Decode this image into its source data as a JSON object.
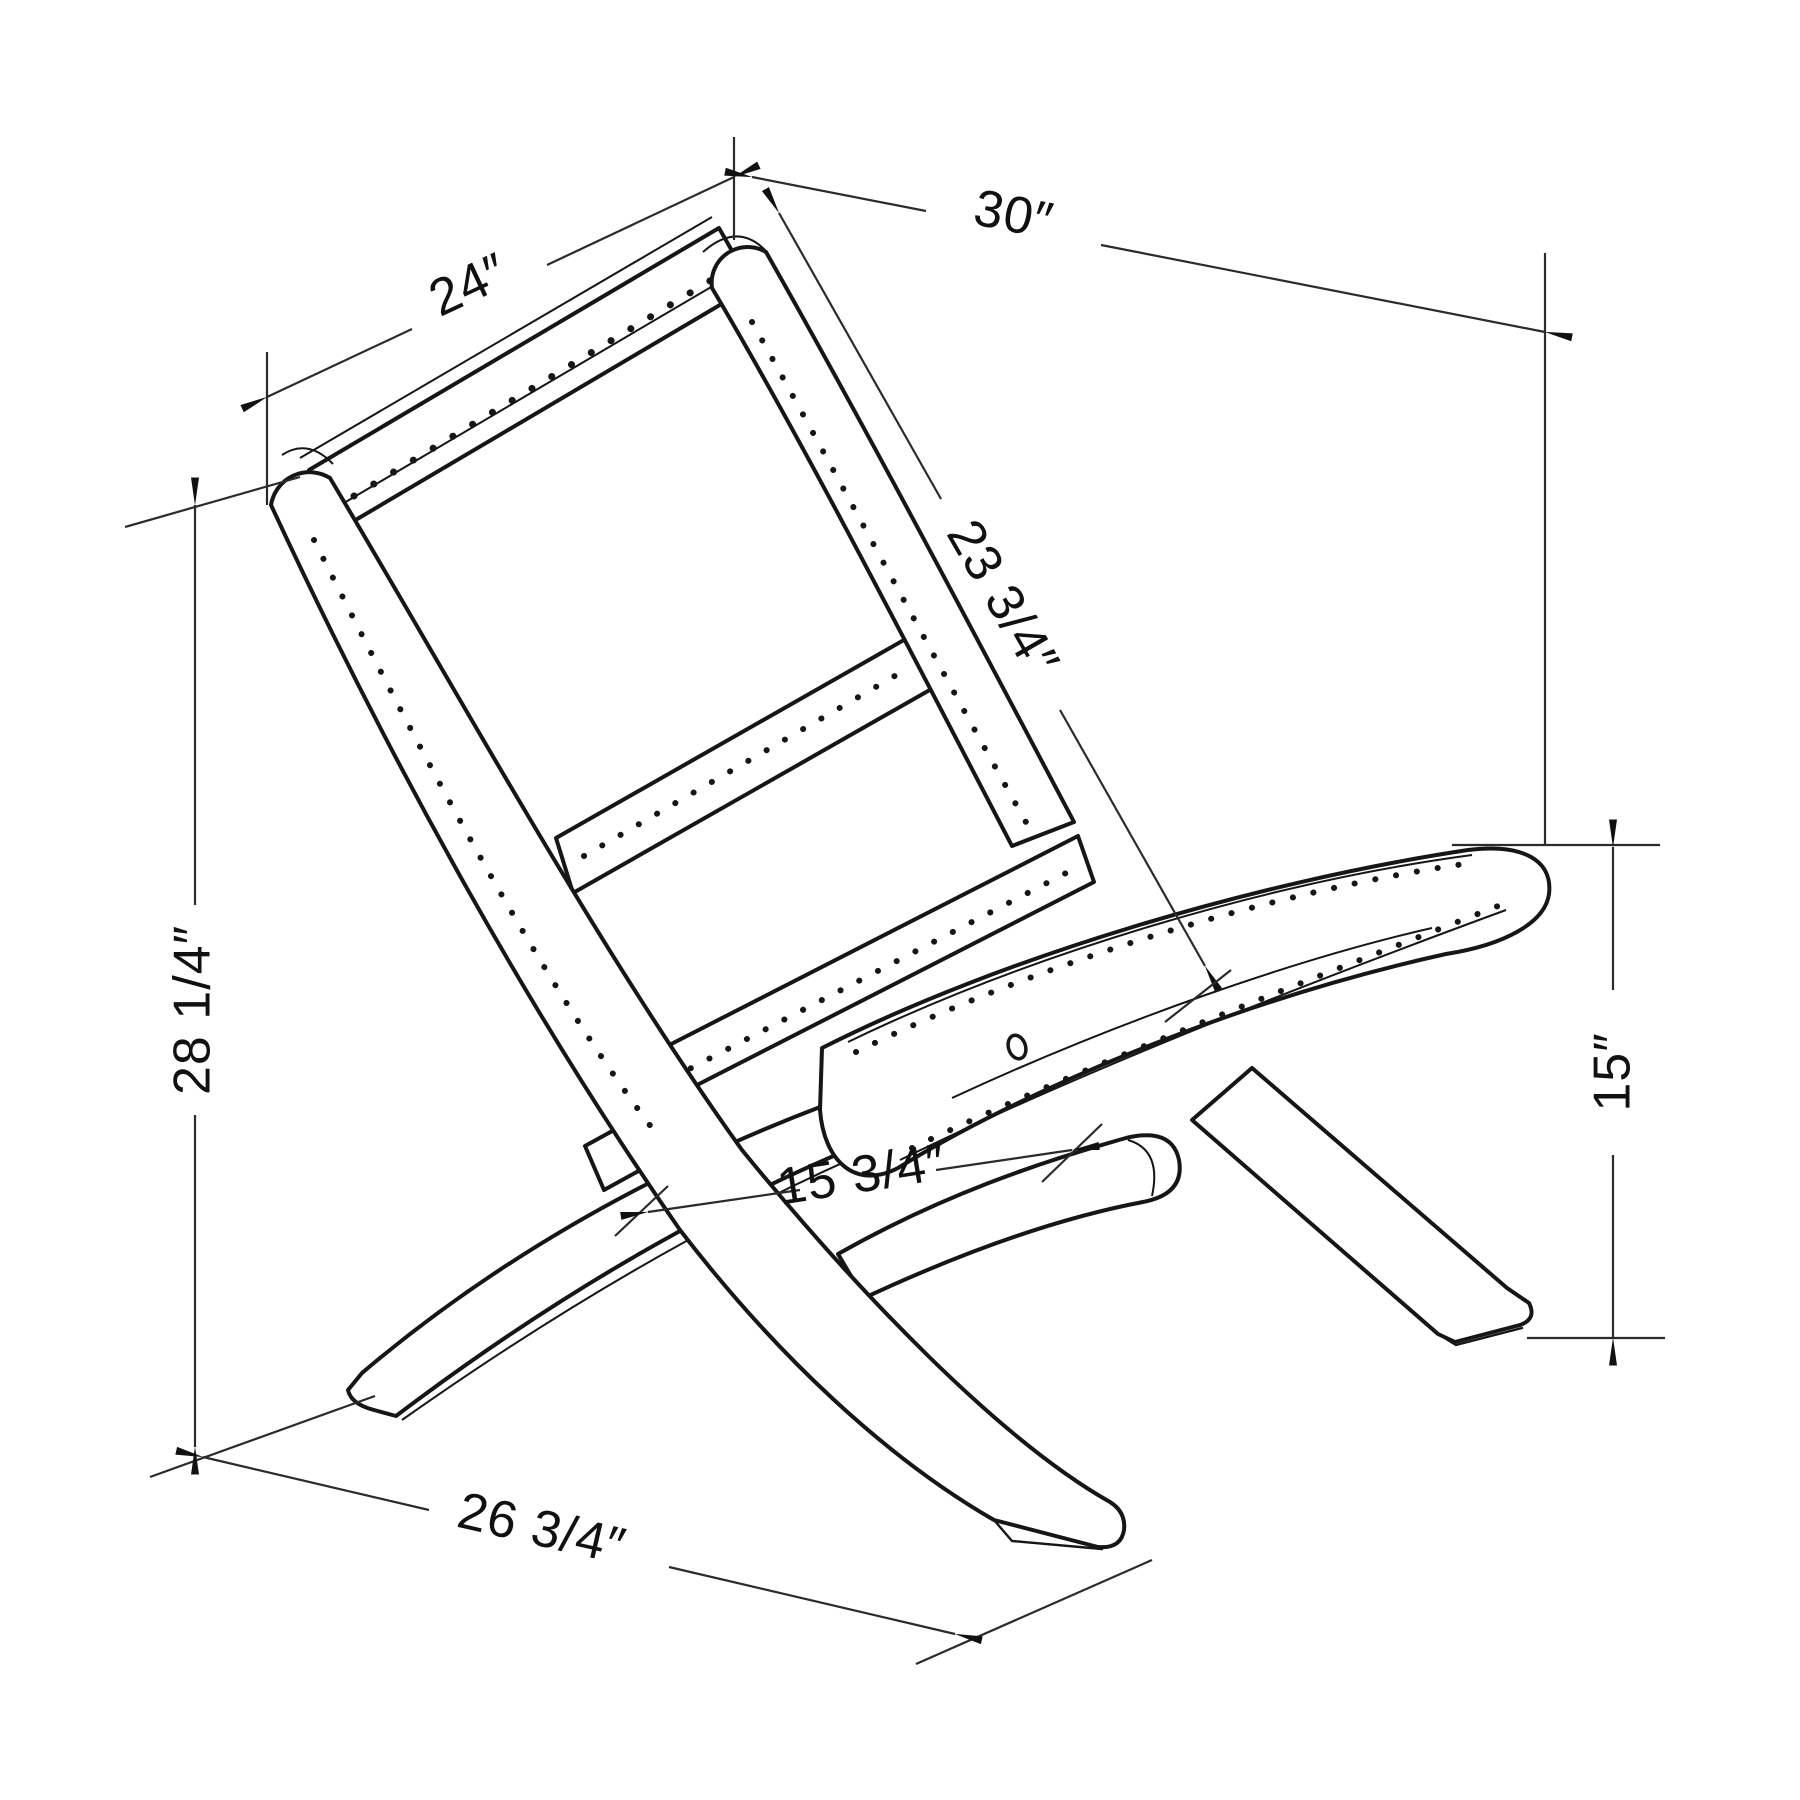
{
  "page": {
    "background": "#ffffff",
    "line_color": "#161616"
  },
  "diagram": {
    "type": "technical-dimension-drawing",
    "subject": "folding chair (isometric line drawing)",
    "units": "inches",
    "dimensions": [
      {
        "id": "back-width",
        "label": "24″",
        "value": 24
      },
      {
        "id": "overall-depth",
        "label": "30″",
        "value": 30
      },
      {
        "id": "backrest-length",
        "label": "23 3/4″",
        "value": 23.75
      },
      {
        "id": "overall-height",
        "label": "28 1/4″",
        "value": 28.25
      },
      {
        "id": "seat-depth",
        "label": "15 3/4″",
        "value": 15.75
      },
      {
        "id": "floor-depth",
        "label": "26 3/4″",
        "value": 26.75
      },
      {
        "id": "seat-height",
        "label": "15″",
        "value": 15
      }
    ]
  },
  "labels": {
    "d24": "24″",
    "d30": "30″",
    "d23_75": "23 3/4″",
    "d28_25": "28 1/4″",
    "d15_75": "15 3/4″",
    "d26_75": "26 3/4″",
    "d15": "15″"
  }
}
